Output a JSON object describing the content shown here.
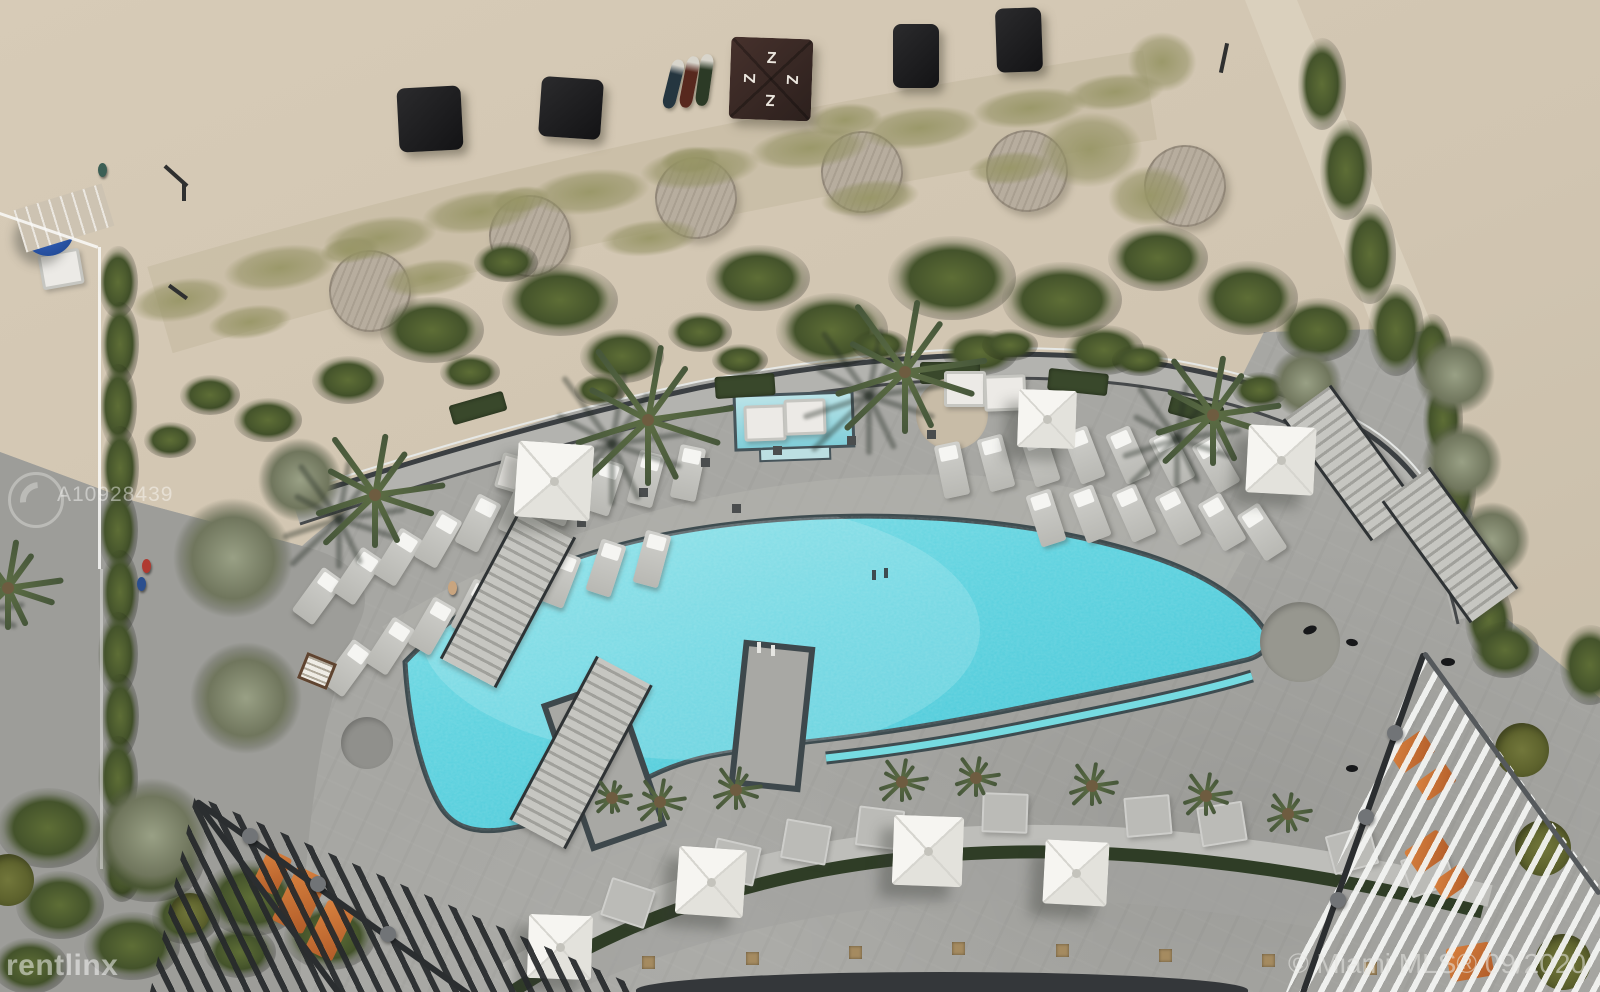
{
  "watermarks": {
    "listing_id": "A10928439",
    "provider": "rentlinx",
    "mls_credit": "© Miami MLS® 09/2020"
  },
  "icons": {
    "tent_logo_glyph": "Z",
    "watermark_logo": "circle-swirl-icon"
  },
  "palette": {
    "sand": "#d3c7b3",
    "deck": "#a7a7a3",
    "pool": "#55cedd",
    "pool_light": "#8ee3e9",
    "pool_coping": "#3e4c50",
    "dune_grass": "#9a9a6b",
    "shrub": "#4d5c2e",
    "turf": "#6b7034",
    "cabana": "#1e1e20",
    "tent": "#3a2a26",
    "umbrella": "#f2f1ed",
    "umbrella_blue": "#2d5cb0",
    "orange_furniture": "#cc6f36",
    "railing": "#3b3f42"
  },
  "scene": {
    "cabanas": [
      [
        430,
        119,
        64,
        64,
        -3
      ],
      [
        571,
        108,
        62,
        60,
        4
      ],
      [
        916,
        56,
        46,
        64,
        0
      ],
      [
        1019,
        40,
        46,
        64,
        -2
      ]
    ],
    "tent": [
      771,
      79,
      82,
      2
    ],
    "kayaks": [
      [
        673,
        84,
        13,
        50,
        14,
        "#253640"
      ],
      [
        689,
        82,
        13,
        52,
        11,
        "#57281e"
      ],
      [
        704,
        80,
        13,
        52,
        8,
        "#2c3a26"
      ]
    ],
    "deck_circles": [
      [
        370,
        291,
        41
      ],
      [
        530,
        236,
        41
      ],
      [
        696,
        198,
        41
      ],
      [
        862,
        172,
        41
      ],
      [
        1027,
        171,
        41
      ],
      [
        1185,
        186,
        41
      ]
    ],
    "dunes": [
      [
        180,
        300,
        66,
        28,
        -10
      ],
      [
        280,
        268,
        76,
        30,
        -8
      ],
      [
        380,
        238,
        76,
        28,
        -8
      ],
      [
        480,
        212,
        78,
        28,
        -8
      ],
      [
        590,
        192,
        80,
        30,
        -6
      ],
      [
        700,
        168,
        80,
        28,
        -6
      ],
      [
        810,
        148,
        80,
        28,
        -6
      ],
      [
        920,
        128,
        80,
        28,
        -6
      ],
      [
        1030,
        108,
        76,
        26,
        -6
      ],
      [
        1115,
        92,
        66,
        24,
        -6
      ],
      [
        250,
        322,
        56,
        22,
        -8
      ],
      [
        430,
        278,
        64,
        24,
        -8
      ],
      [
        650,
        238,
        66,
        24,
        -6
      ],
      [
        870,
        198,
        66,
        24,
        -6
      ],
      [
        1010,
        168,
        56,
        22,
        -6
      ],
      [
        1090,
        150,
        70,
        50,
        -4
      ],
      [
        1150,
        196,
        56,
        40,
        -4
      ],
      [
        1162,
        62,
        46,
        40,
        0
      ],
      [
        845,
        120,
        50,
        22,
        -6
      ],
      [
        350,
        250,
        40,
        18,
        -8
      ],
      [
        520,
        200,
        40,
        18,
        -8
      ],
      [
        690,
        160,
        40,
        18,
        -6
      ]
    ],
    "shrubs": [
      [
        432,
        330,
        52,
        33
      ],
      [
        560,
        300,
        58,
        36
      ],
      [
        622,
        356,
        42,
        27
      ],
      [
        758,
        278,
        52,
        33
      ],
      [
        832,
        330,
        56,
        37
      ],
      [
        952,
        278,
        64,
        42
      ],
      [
        1062,
        300,
        60,
        38
      ],
      [
        1158,
        258,
        50,
        33
      ],
      [
        1248,
        298,
        50,
        37
      ],
      [
        1318,
        330,
        42,
        32
      ],
      [
        980,
        352,
        38,
        23
      ],
      [
        700,
        332,
        32,
        20
      ],
      [
        506,
        262,
        32,
        20
      ],
      [
        1104,
        350,
        40,
        25
      ],
      [
        348,
        380,
        36,
        24
      ],
      [
        268,
        420,
        34,
        22
      ],
      [
        470,
        372,
        30,
        18
      ],
      [
        600,
        390,
        26,
        16
      ],
      [
        740,
        360,
        28,
        16
      ],
      [
        880,
        345,
        28,
        16
      ],
      [
        1010,
        345,
        28,
        16
      ],
      [
        1140,
        360,
        28,
        16
      ],
      [
        1260,
        390,
        28,
        18
      ],
      [
        118,
        282,
        20,
        36
      ],
      [
        120,
        344,
        19,
        42
      ],
      [
        118,
        406,
        19,
        42
      ],
      [
        120,
        468,
        19,
        42
      ],
      [
        118,
        530,
        20,
        42
      ],
      [
        120,
        592,
        19,
        42
      ],
      [
        118,
        654,
        20,
        42
      ],
      [
        120,
        716,
        19,
        42
      ],
      [
        118,
        778,
        20,
        42
      ],
      [
        120,
        836,
        20,
        36
      ],
      [
        122,
        876,
        18,
        26
      ],
      [
        1322,
        84,
        24,
        46
      ],
      [
        1346,
        170,
        26,
        50
      ],
      [
        1370,
        254,
        26,
        50
      ],
      [
        1396,
        330,
        28,
        46
      ],
      [
        1432,
        352,
        20,
        38
      ],
      [
        1443,
        420,
        20,
        42
      ],
      [
        1455,
        490,
        21,
        42
      ],
      [
        1470,
        558,
        22,
        42
      ],
      [
        1489,
        620,
        24,
        38
      ],
      [
        60,
        905,
        44,
        34
      ],
      [
        132,
        946,
        48,
        34
      ],
      [
        30,
        966,
        38,
        28
      ],
      [
        186,
        916,
        34,
        28
      ],
      [
        240,
        952,
        36,
        26
      ],
      [
        48,
        828,
        52,
        40
      ],
      [
        150,
        862,
        54,
        40
      ],
      [
        252,
        898,
        50,
        38
      ],
      [
        330,
        936,
        46,
        34
      ],
      [
        1505,
        650,
        34,
        28
      ],
      [
        1590,
        665,
        30,
        40
      ],
      [
        210,
        395,
        30,
        20
      ],
      [
        170,
        440,
        26,
        18
      ]
    ],
    "trees": [
      [
        233,
        558,
        60
      ],
      [
        246,
        698,
        56
      ],
      [
        152,
        836,
        58
      ],
      [
        300,
        480,
        42
      ],
      [
        1306,
        383,
        36
      ],
      [
        1455,
        375,
        40
      ],
      [
        1462,
        462,
        40
      ],
      [
        1492,
        540,
        38
      ]
    ],
    "planter_boxes": [
      [
        478,
        408,
        56,
        20,
        -16
      ],
      [
        745,
        386,
        60,
        22,
        -4
      ],
      [
        950,
        373,
        60,
        22,
        0
      ],
      [
        1078,
        382,
        60,
        22,
        6
      ],
      [
        1196,
        410,
        54,
        20,
        15
      ]
    ],
    "palms": [
      [
        648,
        420,
        84
      ],
      [
        905,
        372,
        80
      ],
      [
        1213,
        415,
        66
      ],
      [
        375,
        495,
        68
      ],
      [
        8,
        588,
        54
      ]
    ],
    "palm_tufts": [
      [
        612,
        798,
        20
      ],
      [
        660,
        802,
        26
      ],
      [
        736,
        790,
        26
      ],
      [
        902,
        782,
        26
      ],
      [
        976,
        778,
        24
      ],
      [
        1092,
        786,
        26
      ],
      [
        1206,
        796,
        26
      ],
      [
        1288,
        814,
        24
      ]
    ],
    "turf_circles": [
      [
        1522,
        750,
        27
      ],
      [
        1543,
        848,
        28
      ],
      [
        1563,
        962,
        28
      ],
      [
        8,
        880,
        26
      ],
      [
        190,
        913,
        20
      ]
    ],
    "discs": [
      [
        367,
        743,
        26,
        "#90908c"
      ],
      [
        1300,
        642,
        40,
        "#97978f"
      ],
      [
        952,
        414,
        36,
        "#c8bca7"
      ]
    ],
    "loungers": [
      [
        318,
        596,
        36
      ],
      [
        358,
        576,
        34
      ],
      [
        398,
        557,
        32
      ],
      [
        438,
        539,
        30
      ],
      [
        478,
        523,
        27
      ],
      [
        520,
        509,
        24
      ],
      [
        562,
        497,
        21
      ],
      [
        604,
        487,
        18
      ],
      [
        646,
        479,
        15
      ],
      [
        688,
        473,
        12
      ],
      [
        348,
        668,
        36
      ],
      [
        390,
        646,
        33
      ],
      [
        432,
        626,
        30
      ],
      [
        474,
        608,
        27
      ],
      [
        516,
        592,
        24
      ],
      [
        560,
        579,
        21
      ],
      [
        606,
        568,
        18
      ],
      [
        652,
        559,
        15
      ],
      [
        952,
        470,
        -12
      ],
      [
        996,
        463,
        -15
      ],
      [
        1040,
        458,
        -18
      ],
      [
        1084,
        455,
        -21
      ],
      [
        1128,
        455,
        -24
      ],
      [
        1172,
        458,
        -27
      ],
      [
        1216,
        464,
        -30
      ],
      [
        1046,
        518,
        -18
      ],
      [
        1090,
        514,
        -21
      ],
      [
        1134,
        513,
        -24
      ],
      [
        1178,
        516,
        -27
      ],
      [
        1222,
        522,
        -30
      ],
      [
        1262,
        532,
        -33
      ]
    ],
    "daybeds": [
      [
        516,
        472,
        16
      ],
      [
        556,
        460,
        14
      ],
      [
        762,
        420,
        -2
      ],
      [
        802,
        414,
        -2
      ],
      [
        962,
        386,
        0
      ],
      [
        1002,
        390,
        -2
      ],
      [
        58,
        266,
        -10
      ]
    ],
    "bench_pads": [
      [
        628,
        903,
        18
      ],
      [
        735,
        862,
        13
      ],
      [
        806,
        842,
        10
      ],
      [
        880,
        828,
        7
      ],
      [
        1005,
        813,
        2
      ],
      [
        1148,
        816,
        -5
      ],
      [
        1222,
        824,
        -9
      ],
      [
        1352,
        850,
        -15
      ],
      [
        1428,
        872,
        -19
      ]
    ],
    "umbrellas": [
      [
        554,
        481,
        76,
        4
      ],
      [
        1047,
        419,
        58,
        2
      ],
      [
        1281,
        460,
        68,
        3
      ],
      [
        711,
        882,
        68,
        4
      ],
      [
        928,
        851,
        70,
        2
      ],
      [
        1076,
        873,
        64,
        3
      ],
      [
        560,
        947,
        64,
        2
      ]
    ],
    "umbrella_blue": [
      48,
      230,
      52
    ],
    "stairs": [
      [
        505,
        598,
        58,
        170,
        28
      ],
      [
        578,
        752,
        58,
        185,
        28
      ],
      [
        1348,
        463,
        54,
        150,
        -36
      ],
      [
        1447,
        545,
        54,
        150,
        -36
      ]
    ],
    "furniture_orange": [
      [
        300,
        900,
        34,
        60,
        26
      ],
      [
        330,
        930,
        30,
        55,
        26
      ],
      [
        272,
        872,
        26,
        40,
        26
      ],
      [
        1412,
        752,
        40,
        26,
        -35
      ],
      [
        1436,
        782,
        36,
        22,
        -35
      ],
      [
        1428,
        852,
        40,
        28,
        -35
      ],
      [
        1452,
        882,
        34,
        22,
        -35
      ],
      [
        1470,
        962,
        44,
        34,
        -10
      ]
    ],
    "people": [
      [
        146,
        566,
        "#b03a30"
      ],
      [
        141,
        584,
        "#2b4f8e"
      ],
      [
        452,
        588,
        "#c9a57f"
      ],
      [
        102,
        170,
        "#3c5f55"
      ]
    ],
    "sign": [
      314,
      668,
      26,
      22,
      22
    ],
    "dark_objects": [
      [
        1310,
        630,
        14,
        8,
        -20
      ],
      [
        1352,
        642,
        12,
        7,
        10
      ],
      [
        1448,
        662,
        14,
        8,
        0
      ],
      [
        1352,
        768,
        12,
        7,
        0
      ]
    ],
    "beach_marks": [
      [
        176,
        176,
        30,
        4,
        42
      ],
      [
        184,
        192,
        4,
        18,
        0
      ],
      [
        178,
        292,
        22,
        4,
        36
      ],
      [
        1224,
        58,
        4,
        30,
        12
      ]
    ],
    "pavers": [
      [
        648,
        962
      ],
      [
        752,
        958
      ],
      [
        855,
        952
      ],
      [
        958,
        948
      ],
      [
        1062,
        950
      ],
      [
        1165,
        955
      ],
      [
        1268,
        960
      ],
      [
        1370,
        968
      ]
    ],
    "drains": [
      [
        705,
        462
      ],
      [
        643,
        492
      ],
      [
        581,
        522
      ],
      [
        777,
        450
      ],
      [
        851,
        440
      ],
      [
        931,
        434
      ],
      [
        736,
        508
      ]
    ]
  }
}
